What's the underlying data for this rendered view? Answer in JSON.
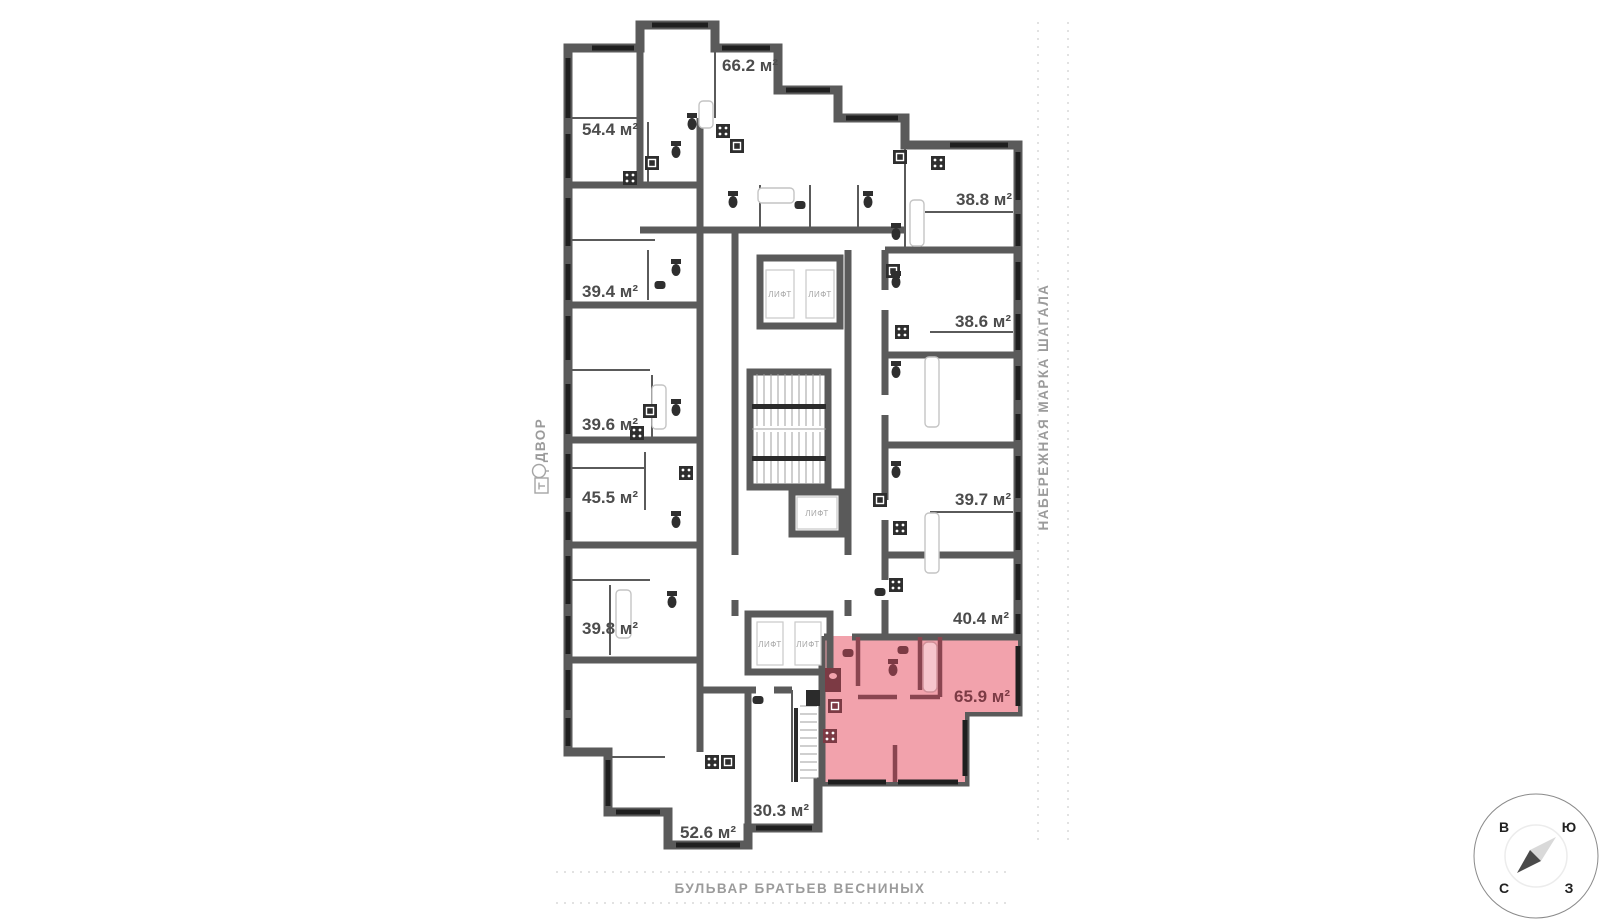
{
  "labels": {
    "lift": "ЛИФТ"
  },
  "streets": {
    "left_vertical": "ДВОР",
    "right_vertical": "НАБЕРЕЖНАЯ МАРКА ШАГАЛА",
    "bottom": "БУЛЬВАР БРАТЬЕВ ВЕСНИНЫХ"
  },
  "compass": {
    "top_left": "В",
    "top_right": "Ю",
    "bottom_left": "С",
    "bottom_right": "З"
  },
  "rooms": [
    {
      "name": "apartment-66-2",
      "area": "66.2 м²",
      "highlighted": false
    },
    {
      "name": "apartment-54-4",
      "area": "54.4 м²",
      "highlighted": false
    },
    {
      "name": "apartment-39-4",
      "area": "39.4 м²",
      "highlighted": false
    },
    {
      "name": "apartment-39-6",
      "area": "39.6 м²",
      "highlighted": false
    },
    {
      "name": "apartment-45-5",
      "area": "45.5 м²",
      "highlighted": false
    },
    {
      "name": "apartment-39-8",
      "area": "39.8 м²",
      "highlighted": false
    },
    {
      "name": "apartment-52-6",
      "area": "52.6 м²",
      "highlighted": false
    },
    {
      "name": "apartment-30-3",
      "area": "30.3 м²",
      "highlighted": false
    },
    {
      "name": "apartment-38-8",
      "area": "38.8 м²",
      "highlighted": false
    },
    {
      "name": "apartment-38-6",
      "area": "38.6 м²",
      "highlighted": false
    },
    {
      "name": "apartment-39-7",
      "area": "39.7 м²",
      "highlighted": false
    },
    {
      "name": "apartment-40-4",
      "area": "40.4 м²",
      "highlighted": false
    },
    {
      "name": "apartment-65-9",
      "area": "65.9 м²",
      "highlighted": true
    }
  ],
  "colors": {
    "wall": "#5a5a5a",
    "window": "#1f1f1f",
    "highlight_fill": "#f2a2ac",
    "highlight_wall": "#8a4550",
    "area_label": "#4c4c4c",
    "highlight_label": "#7c3b45",
    "street_label": "#9b9b9b",
    "dotted_line": "#d9d9d9"
  }
}
